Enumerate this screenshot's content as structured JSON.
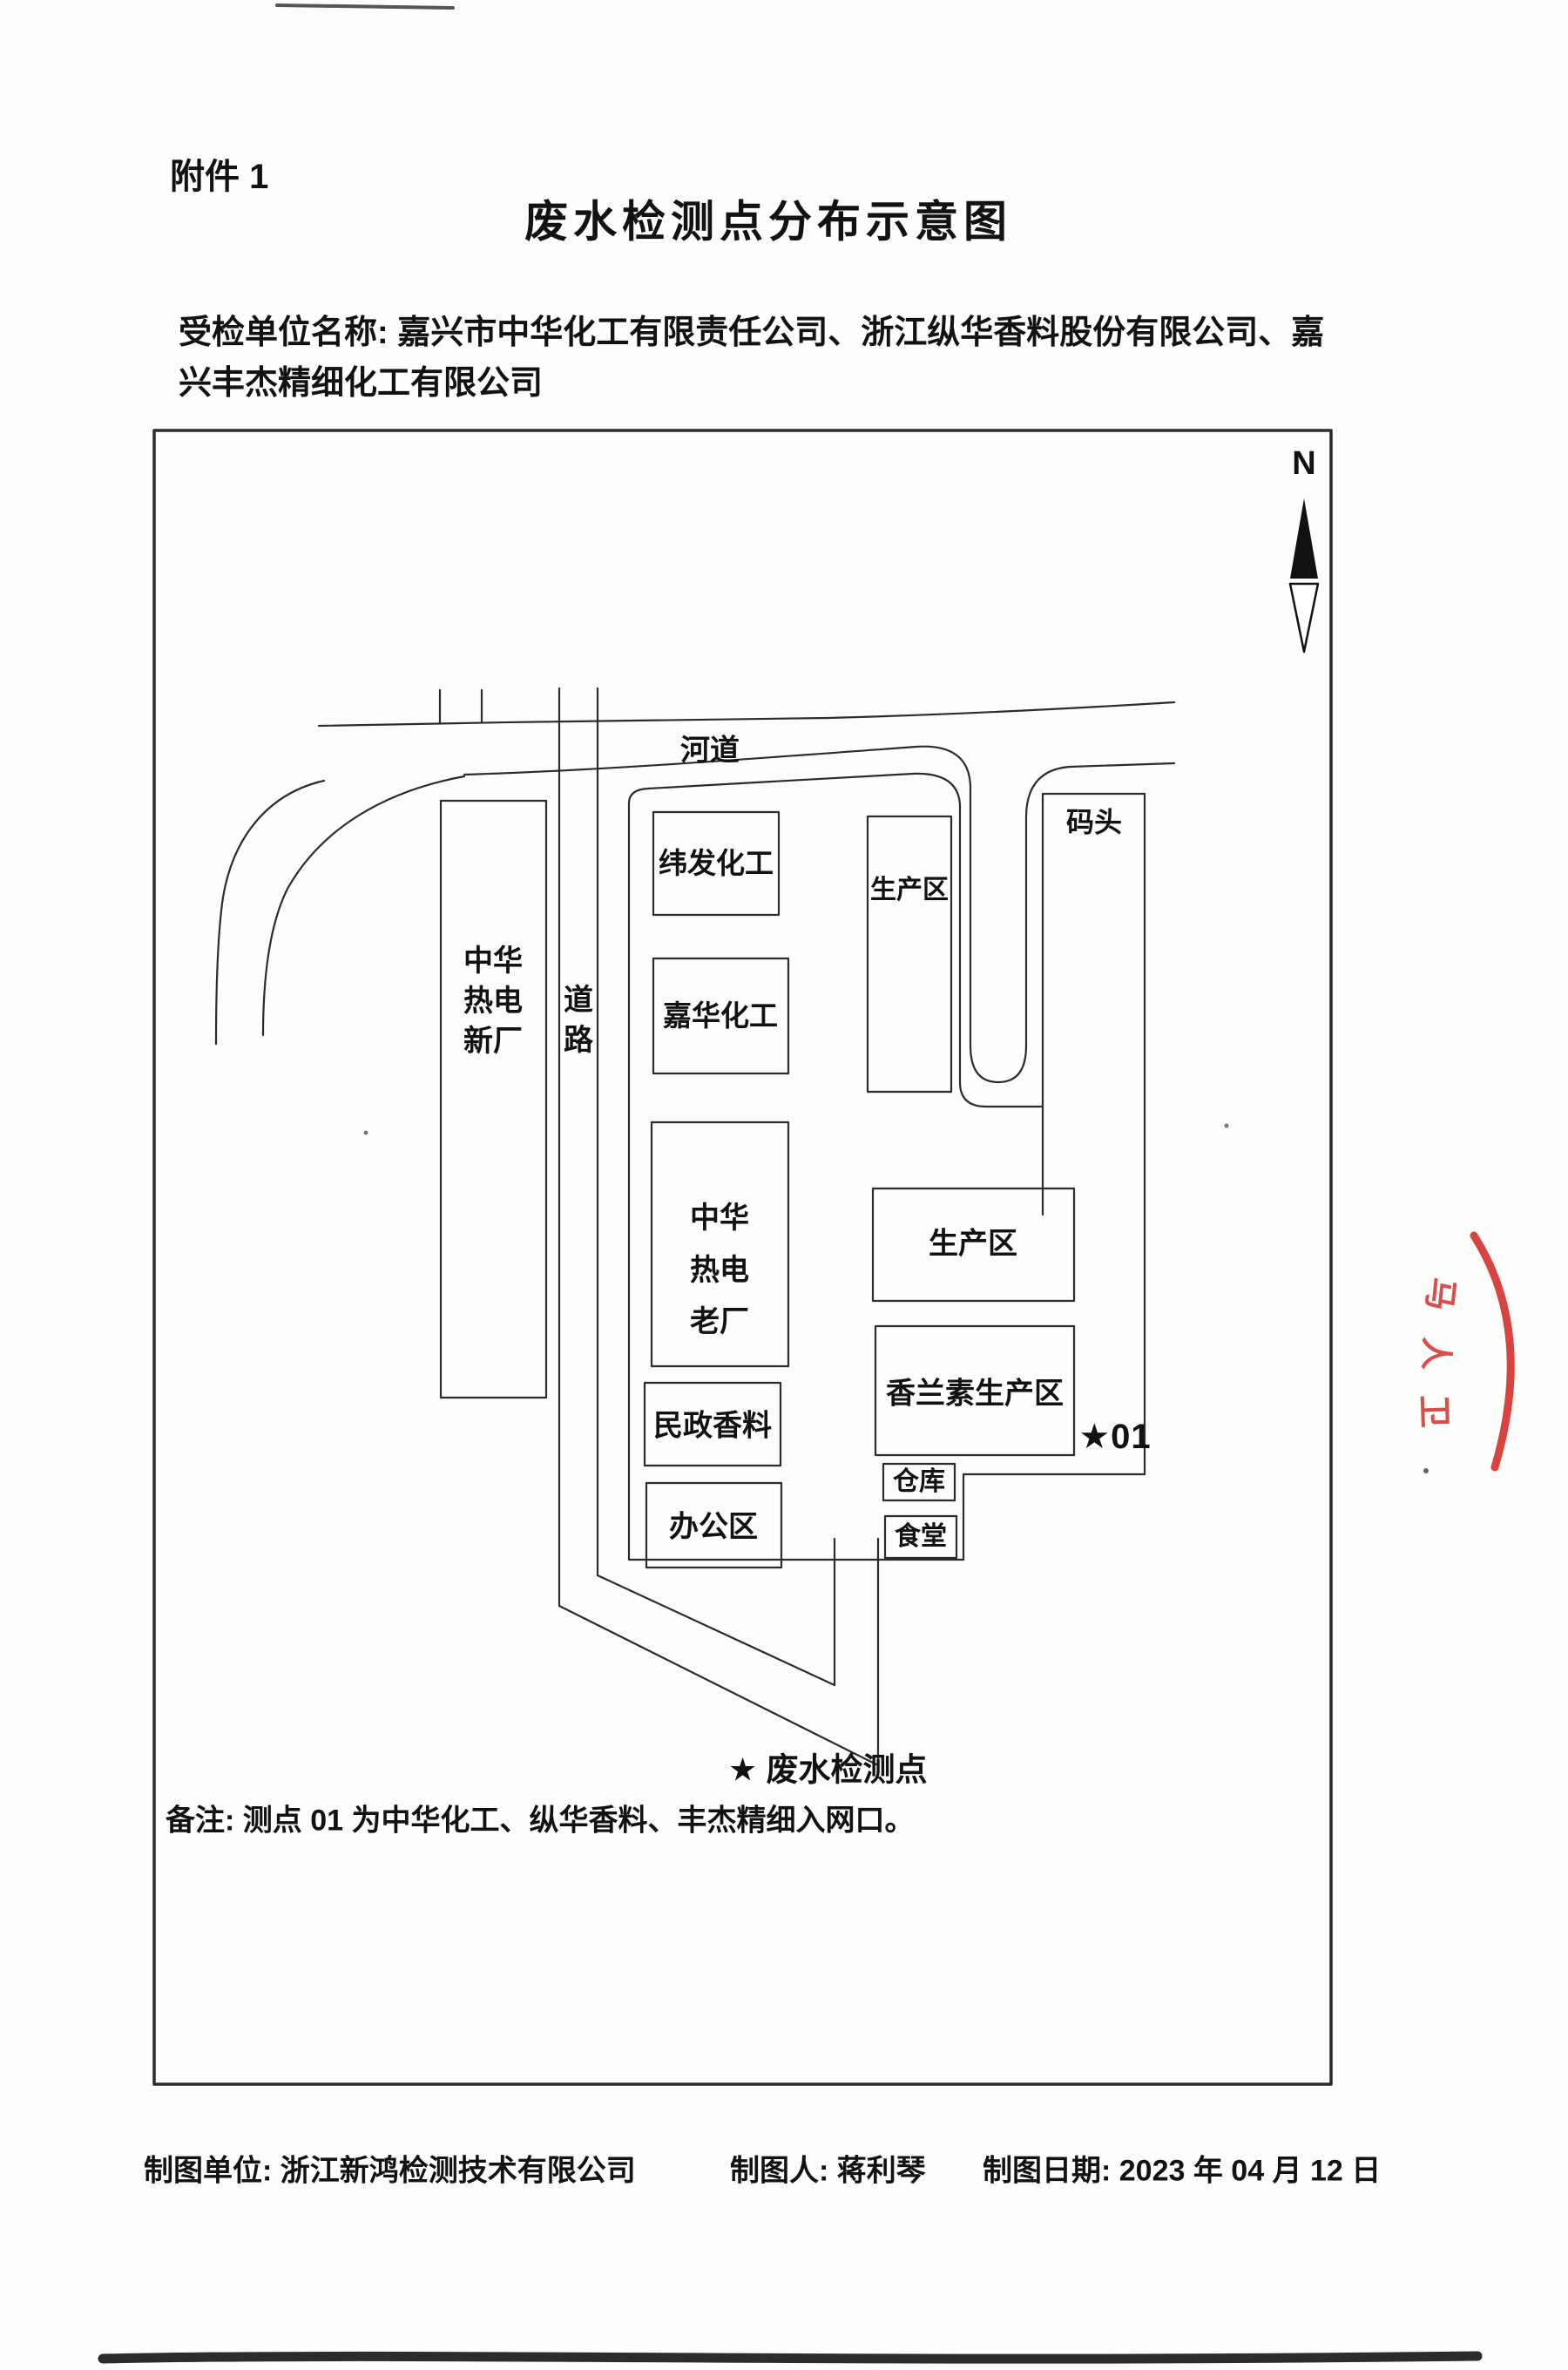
{
  "page": {
    "attachment_label": "附件 1",
    "title": "废水检测点分布示意图",
    "inspected_org_line1": "受检单位名称: 嘉兴市中华化工有限责任公司、浙江纵华香料股份有限公司、嘉",
    "inspected_org_line2": "兴丰杰精细化工有限公司"
  },
  "map": {
    "north_label": "N",
    "river_label": "河道",
    "road_label": "道\n路",
    "dock_label": "码头",
    "buildings": {
      "zhonghua_new": "中华\n热电\n新厂",
      "weifa": "纬发化工",
      "jiahua": "嘉华化工",
      "zhonghua_old": "中华\n热电\n老厂",
      "minzheng": "民政香料",
      "office": "办公区",
      "prod_north": "生产区",
      "prod_mid": "生产区",
      "vanillin": "香兰素生产区",
      "warehouse": "仓库",
      "canteen": "食堂"
    },
    "monitor_point": "★01"
  },
  "legend": {
    "symbol_and_label": "★  废水检测点"
  },
  "note": "备注: 测点 01 为中华化工、纵华香料、丰杰精细入网口。",
  "footer": {
    "unit": "制图单位: 浙江新鸿检测技术有限公司",
    "drafter": "制图人: 蒋利琴",
    "date": "制图日期: 2023 年 04 月 12 日"
  },
  "stamp": {
    "color": "#d2231f",
    "chars": [
      "马",
      "人",
      "卫"
    ]
  }
}
